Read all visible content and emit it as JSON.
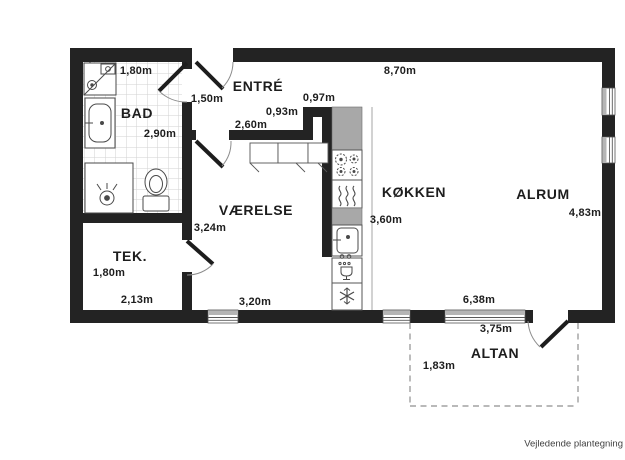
{
  "footer": "Vejledende plantegning",
  "rooms": {
    "bad": "BAD",
    "entre": "ENTRÉ",
    "vaerelse": "VÆRELSE",
    "koekken": "KØKKEN",
    "alrum": "ALRUM",
    "tek": "TEK.",
    "altan": "ALTAN"
  },
  "dims": {
    "bad_width": "1,80m",
    "bad_depth": "2,90m",
    "entre_opening": "1,50m",
    "top_width": "8,70m",
    "passage": "0,97m",
    "step": "0,93m",
    "entre_wall": "2,60m",
    "vaerelse_width": "3,24m",
    "koekken_depth": "3,60m",
    "alrum_width": "4,83m",
    "tek_depth": "1,80m",
    "tek_width": "2,13m",
    "vaerelse_south": "3,20m",
    "altan_width": "6,38m",
    "altan_door_span": "3,75m",
    "altan_depth": "1,83m"
  },
  "colors": {
    "wall": "#232323",
    "kitchen_counter": "#a8a8a8",
    "fixture_outline": "#4a4a4a",
    "balcony_dash": "#8f8f8f",
    "text": "#1d1d1d"
  }
}
